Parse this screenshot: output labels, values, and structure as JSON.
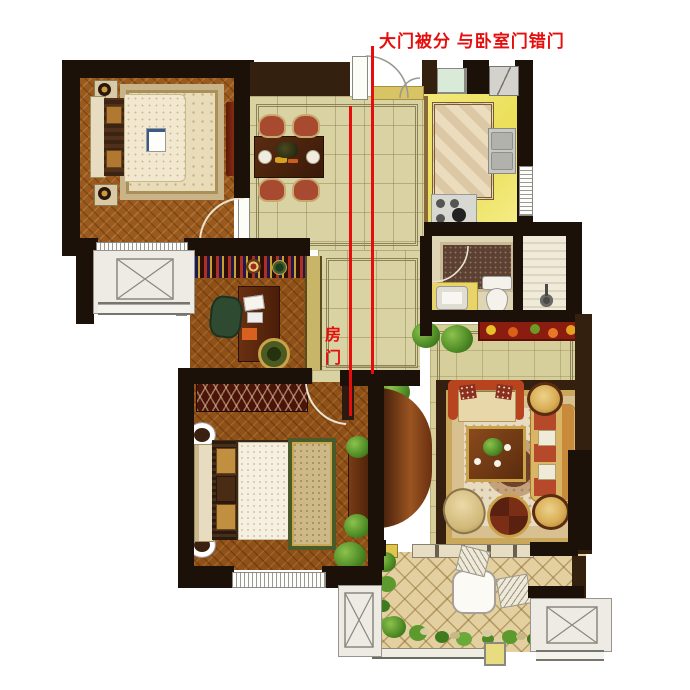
{
  "annotations": {
    "main_note": "大门被分 与卧室门错门",
    "room_door_note": "房门",
    "note_color": "#e60d0d"
  },
  "palette": {
    "annotation_red": "#e60d0d",
    "wall_dark": "#1c1109",
    "wall_brown": "#33200f",
    "wood_floor": "#9a5a1e",
    "hall_tile": "#d9d2a2",
    "kitchen_floor": "#f1e468",
    "terrace_tile": "#e3cf9f",
    "wardrobe_red": "#4a1408"
  }
}
